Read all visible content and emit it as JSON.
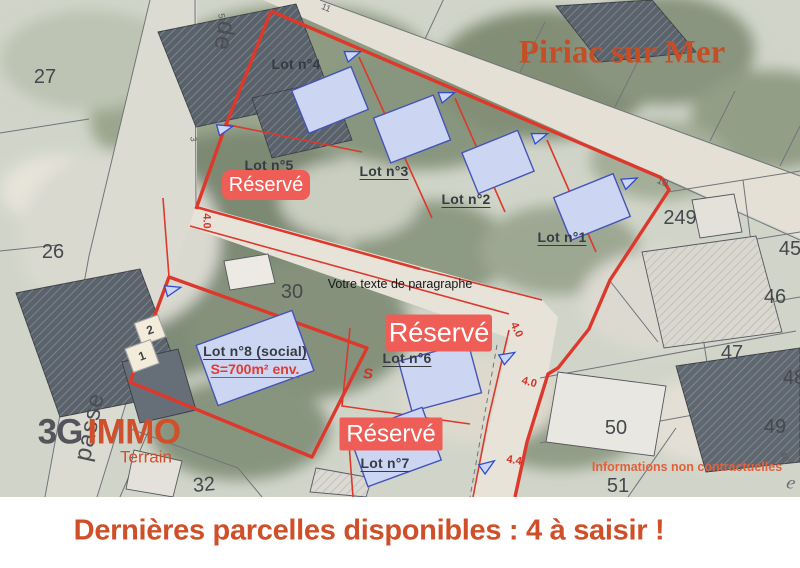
{
  "title": "Piriac sur Mer",
  "banner_text": "Dernières parcelles disponibles : 4 à saisir !",
  "disclaimer": "Informations non contractuelles",
  "note": "Votre texte de paragraphe",
  "reserved_label": "Réservé",
  "logo": {
    "brand_3g": "3G",
    "brand_immo": "IMMO",
    "brand_sub": "Terrain"
  },
  "lots": {
    "lot1": "Lot n°1",
    "lot2": "Lot n°2",
    "lot3": "Lot n°3",
    "lot4": "Lot n°4",
    "lot5": "Lot n°5",
    "lot6": "Lot n°6",
    "lot7": "Lot n°7",
    "lot8": "Lot n°8 (social)",
    "lot8_area": "S=700m² env."
  },
  "dimensions": {
    "road_width_west": "4.0",
    "road_width_mid": "4.0",
    "road_width_south": "4.0",
    "road_width_bottom": "4.4"
  },
  "parcel_numbers": {
    "n27": "27",
    "n26": "26",
    "n30": "30",
    "n32": "32",
    "n249": "249",
    "n45": "45",
    "n46": "46",
    "n47": "47",
    "n48": "48",
    "n49": "49",
    "n50": "50",
    "n51": "51"
  },
  "survey_marks": {
    "m11": "11",
    "m10": "10",
    "m5": "5",
    "m3": "3",
    "m48": "48",
    "street_e": "e"
  },
  "street_labels": {
    "de": "de",
    "impasse": "passe"
  },
  "map_marker_s": "S",
  "parking_numbers": {
    "p1": "1",
    "p2": "2"
  },
  "colors": {
    "accent_orange": "#cf4f28",
    "badge_red": "#ee5e57",
    "boundary_red": "#dc392c",
    "house_blue": "#ccd6f2"
  }
}
